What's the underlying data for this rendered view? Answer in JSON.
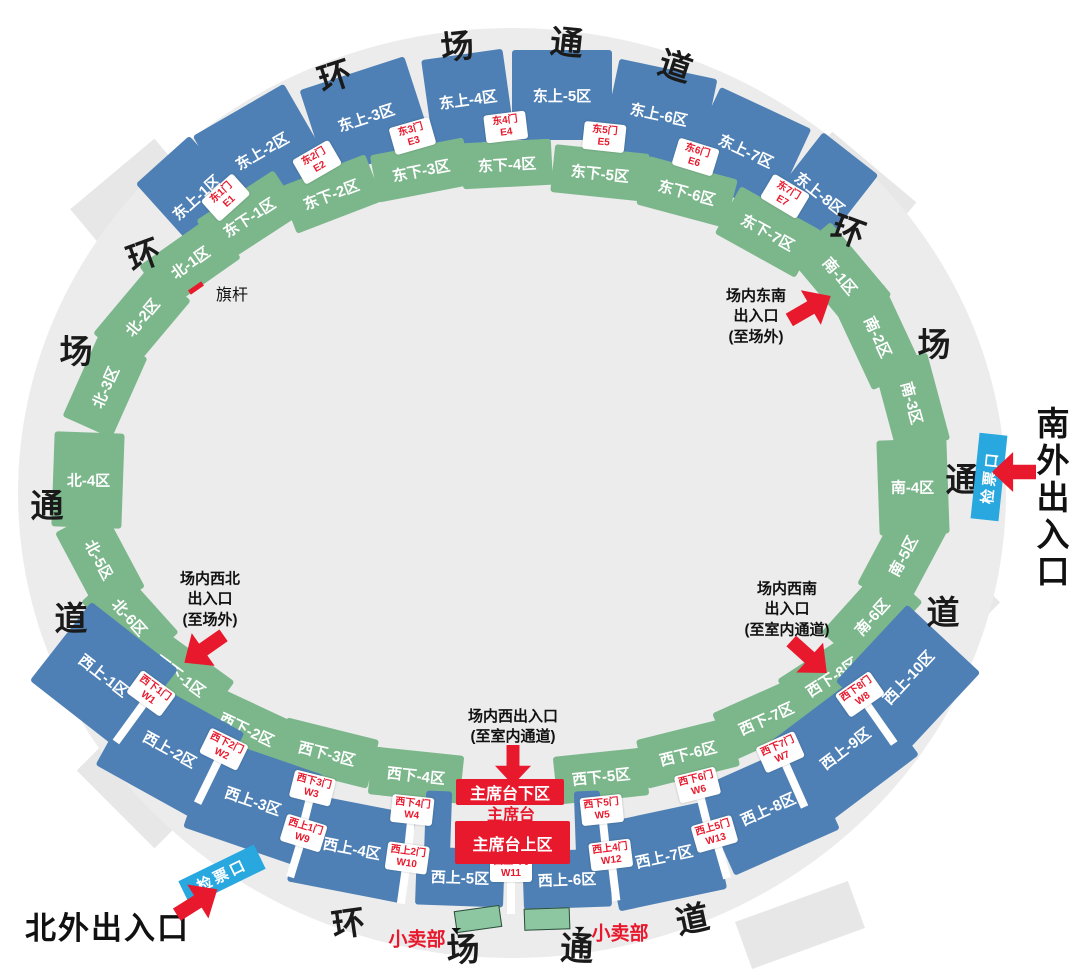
{
  "colors": {
    "upper_row_blue": "#4e80b5",
    "lower_row_green": "#7cb78c",
    "accent_red": "#e8192d",
    "ticket_blue": "#29a7df",
    "ring_gray": "#ececec",
    "shop_green": "#8cc7a2"
  },
  "ring_corridor_chars": [
    "环",
    "场",
    "通",
    "道"
  ],
  "sections": {
    "east_upper": [
      "东上-1区",
      "东上-2区",
      "东上-3区",
      "东上-4区",
      "东上-5区",
      "东上-6区",
      "东上-7区",
      "东上-8区"
    ],
    "east_lower": [
      "东下-1区",
      "东下-2区",
      "东下-3区",
      "东下-4区",
      "东下-5区",
      "东下-6区",
      "东下-7区"
    ],
    "north": [
      "北-1区",
      "北-2区",
      "北-3区",
      "北-4区",
      "北-5区",
      "北-6区"
    ],
    "south": [
      "南-1区",
      "南-2区",
      "南-3区",
      "南-4区",
      "南-5区",
      "南-6区"
    ],
    "west_lower": [
      "西下-1区",
      "西下-2区",
      "西下-3区",
      "西下-4区",
      "西下-5区",
      "西下-6区",
      "西下-7区",
      "西下-8区"
    ],
    "west_upper": [
      "西上-1区",
      "西上-2区",
      "西上-3区",
      "西上-4区",
      "西上-5区",
      "西上-6区",
      "西上-7区",
      "西上-8区",
      "西上-9区",
      "西上-10区"
    ]
  },
  "gates": {
    "east": [
      {
        "name": "东1门",
        "code": "E1"
      },
      {
        "name": "东2门",
        "code": "E2"
      },
      {
        "name": "东3门",
        "code": "E3"
      },
      {
        "name": "东4门",
        "code": "E4"
      },
      {
        "name": "东5门",
        "code": "E5"
      },
      {
        "name": "东6门",
        "code": "E6"
      },
      {
        "name": "东7门",
        "code": "E7"
      }
    ],
    "west_lower": [
      {
        "name": "西下1门",
        "code": "W1"
      },
      {
        "name": "西下2门",
        "code": "W2"
      },
      {
        "name": "西下3门",
        "code": "W3"
      },
      {
        "name": "西下4门",
        "code": "W4"
      },
      {
        "name": "西下5门",
        "code": "W5"
      },
      {
        "name": "西下6门",
        "code": "W6"
      },
      {
        "name": "西下7门",
        "code": "W7"
      },
      {
        "name": "西下8门",
        "code": "W8"
      }
    ],
    "west_upper": [
      {
        "name": "西上1门",
        "code": "W9"
      },
      {
        "name": "西上2门",
        "code": "W10"
      },
      {
        "name": "西上3门",
        "code": "W11"
      },
      {
        "name": "西上4门",
        "code": "W12"
      },
      {
        "name": "西上5门",
        "code": "W13"
      }
    ]
  },
  "stage": {
    "lower_label": "主席台下区",
    "name_label": "主席台",
    "upper_label": "主席台上区"
  },
  "labels": {
    "flagpole": "旗杆",
    "ticket_check": "检票口",
    "shop": "小卖部",
    "south_outer_entrance": "南外出入口",
    "north_outer_entrance": "北外出入口",
    "se_entrance": [
      "场内东南",
      "出入口",
      "(至场外)"
    ],
    "nw_entrance": [
      "场内西北",
      "出入口",
      "(至场外)"
    ],
    "sw_entrance": [
      "场内西南",
      "出入口",
      "(至室内通道)"
    ],
    "w_entrance": [
      "场内西出入口",
      "(至室内通道)"
    ]
  }
}
